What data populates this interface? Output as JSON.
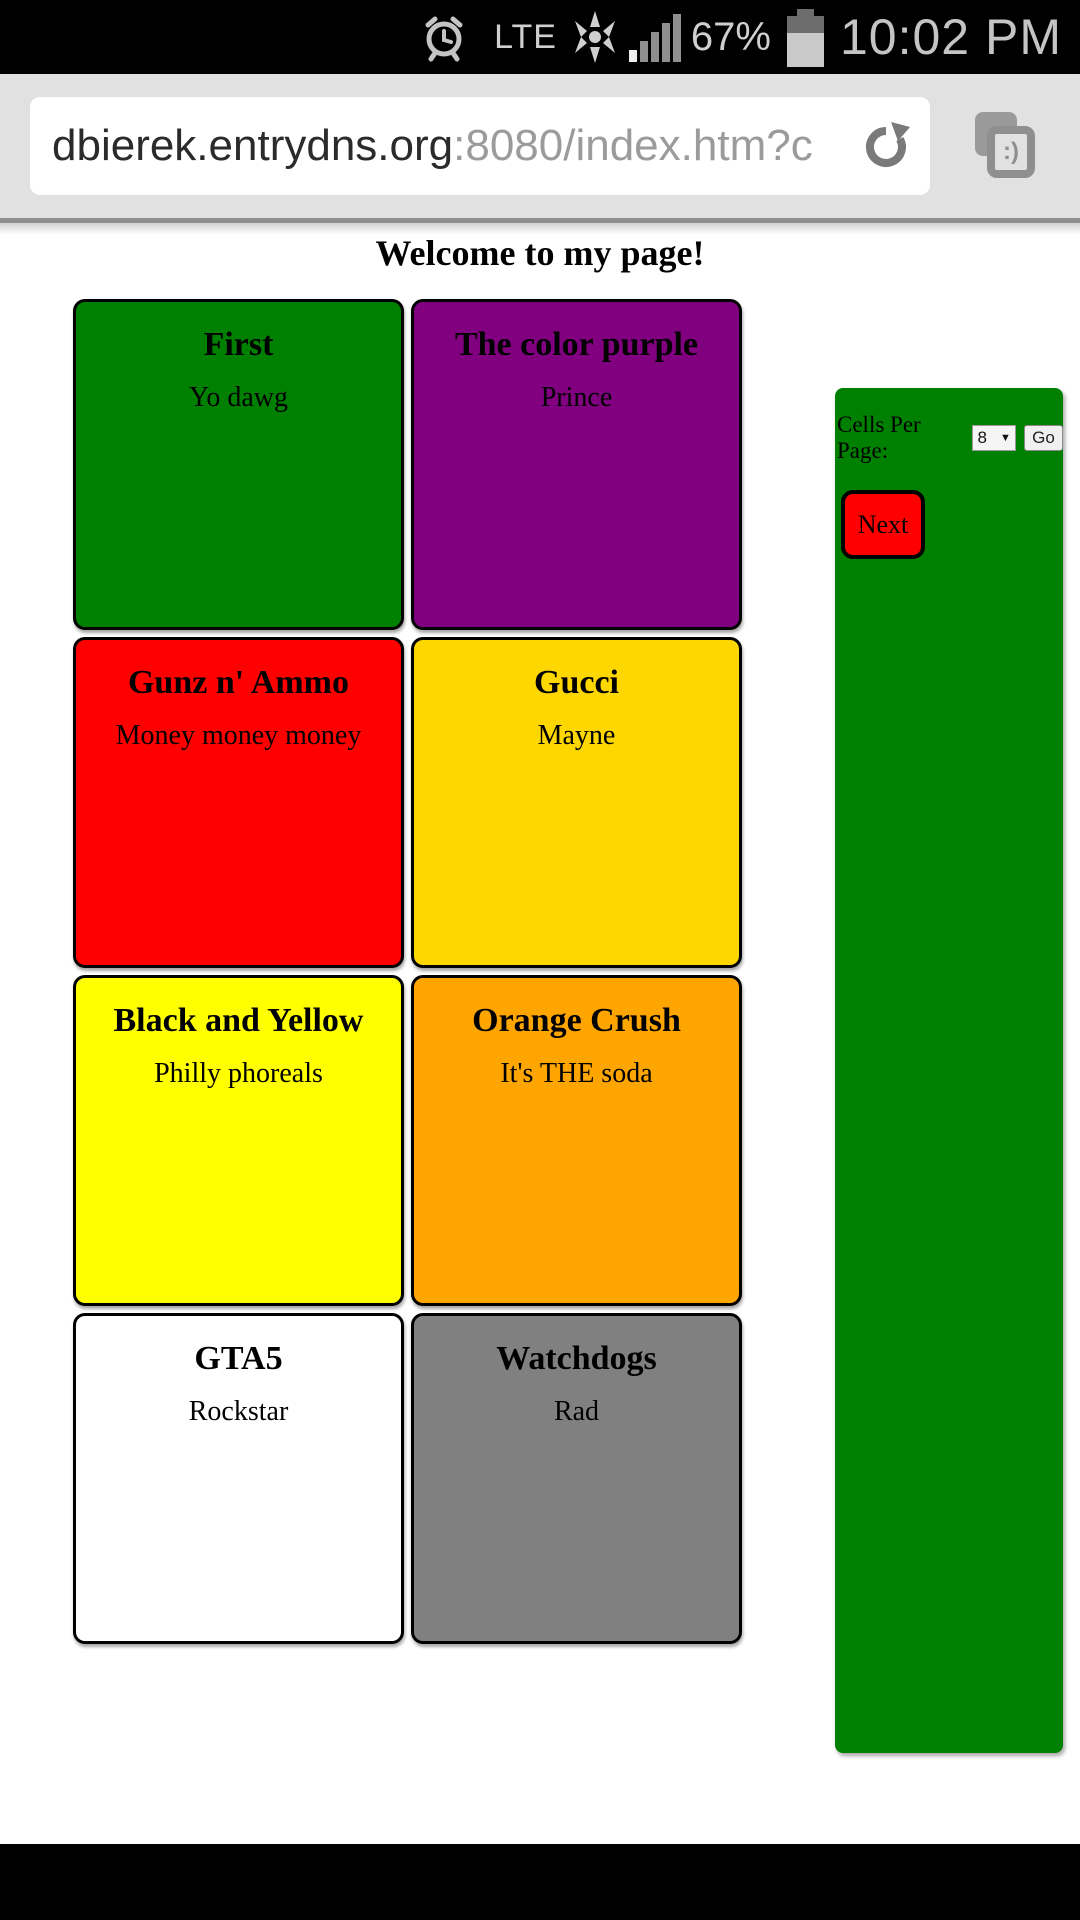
{
  "status_bar": {
    "carrier": "LTE",
    "battery_percent": "67%",
    "time": "10:02 PM"
  },
  "browser": {
    "url_host": "dbierek.entrydns.org",
    "url_path": ":8080/index.htm?c",
    "tabs_label": ":)"
  },
  "page": {
    "title": "Welcome to my page!",
    "cells": [
      {
        "title": "First",
        "subtitle": "Yo dawg",
        "color": "#008000"
      },
      {
        "title": "The color purple",
        "subtitle": "Prince",
        "color": "#800080"
      },
      {
        "title": "Gunz n' Ammo",
        "subtitle": "Money money money",
        "color": "#ff0000"
      },
      {
        "title": "Gucci",
        "subtitle": "Mayne",
        "color": "#ffd700"
      },
      {
        "title": "Black and Yellow",
        "subtitle": "Philly phoreals",
        "color": "#ffff00"
      },
      {
        "title": "Orange Crush",
        "subtitle": "It's THE soda",
        "color": "#ffa500"
      },
      {
        "title": "GTA5",
        "subtitle": "Rockstar",
        "color": "#ffffff"
      },
      {
        "title": "Watchdogs",
        "subtitle": "Rad",
        "color": "#808080"
      }
    ],
    "sidebar": {
      "cells_per_page_label": "Cells Per Page:",
      "cells_per_page_value": "8",
      "go_label": "Go",
      "next_label": "Next",
      "bg_color": "#008000"
    }
  }
}
